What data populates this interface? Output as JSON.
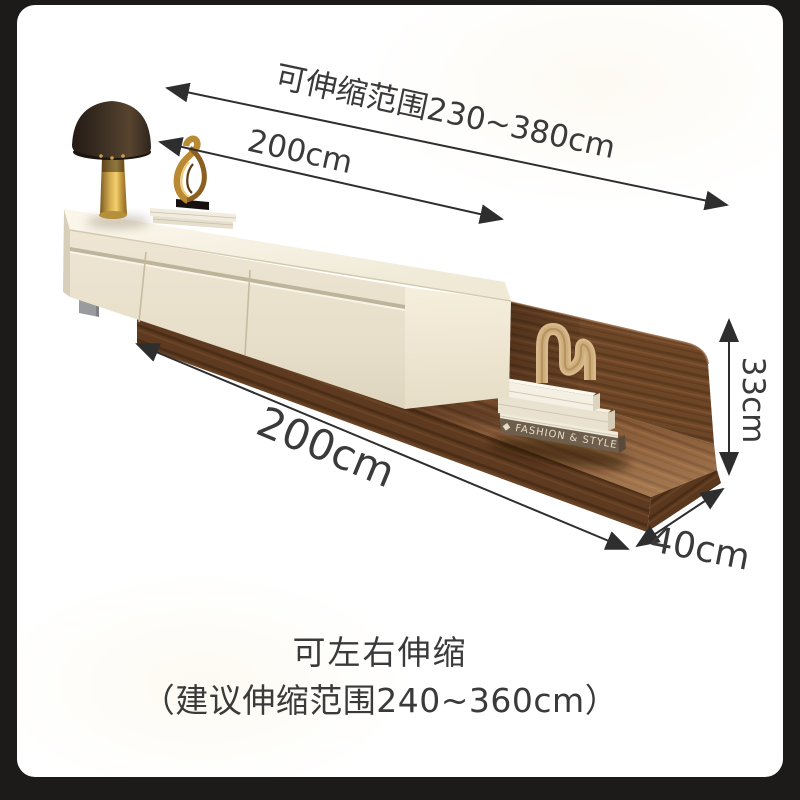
{
  "scene": {
    "type": "furniture-product-dimension-image",
    "background_color": "#1d1b19",
    "card_color": "#ffffff",
    "dimension_line_color": "#2e2e2e",
    "text_color": "#3a3a3a",
    "wood_color": "#6b4425",
    "cabinet_color": "#e8e0cc",
    "objects": [
      "mushroom-table-lamp",
      "gold-abstract-sculpture",
      "white-book-stacks",
      "rattan-arch-ornament",
      "cream-tv-cabinet",
      "walnut-base-board-with-back-panel"
    ]
  },
  "dimensions": {
    "extension_range": "可伸缩范围230~380cm",
    "cabinet_width": "200cm",
    "base_width": "200cm",
    "panel_height": "33cm",
    "base_depth": "40cm"
  },
  "caption": {
    "line1": "可左右伸缩",
    "line2": "（建议伸缩范围240~360cm）"
  },
  "decor": {
    "book_spine": "◆ FASHION & STYLE"
  }
}
